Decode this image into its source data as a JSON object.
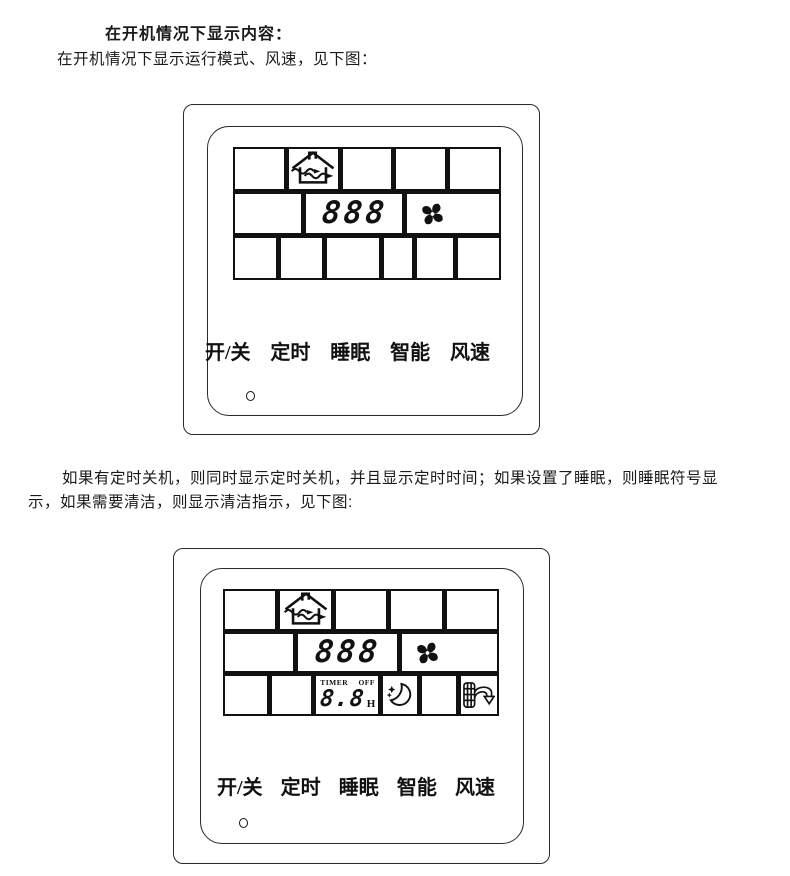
{
  "doc": {
    "heading": "在开机情况下显示内容：",
    "intro": "在开机情况下显示运行模式、风速，见下图：",
    "paragraph": "如果有定时关机，则同时显示定时关机，并且显示定时时间；如果设置了睡眠，则睡眠符号显示，如果需要清洁，则显示清洁指示，见下图:"
  },
  "panel1": {
    "lcd": {
      "mode_icon": "house-airflow-icon",
      "fan_icon": "fan-blades-icon",
      "temp": "888"
    },
    "buttons": [
      "开/关",
      "定时",
      "睡眠",
      "智能",
      "风速"
    ]
  },
  "panel2": {
    "lcd": {
      "mode_icon": "house-airflow-icon",
      "fan_icon": "fan-blades-icon",
      "temp": "888",
      "timer_label": "TIMER",
      "off_label": "OFF",
      "timer_value": "8.8",
      "timer_unit": "H",
      "sleep_icon": "moon-stars-icon",
      "clean_icon": "filter-clean-icon"
    },
    "buttons": [
      "开/关",
      "定时",
      "睡眠",
      "智能",
      "风速"
    ]
  },
  "colors": {
    "ink": "#111111",
    "paper": "#ffffff"
  }
}
